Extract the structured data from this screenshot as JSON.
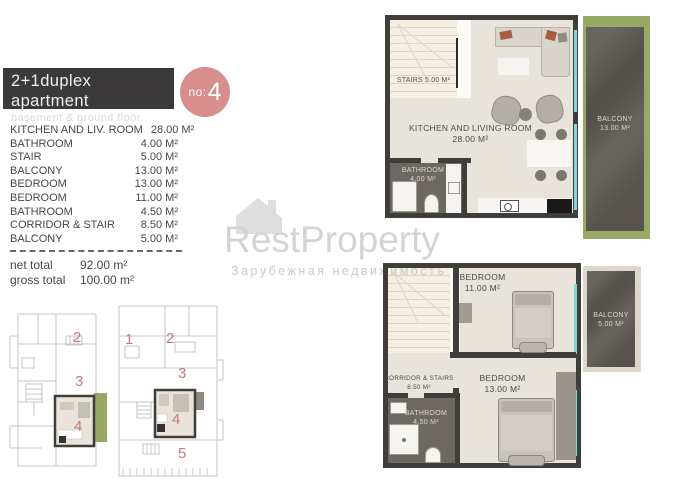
{
  "header": {
    "title": "2+1duplex apartment",
    "subtitle": "basement & ground floor",
    "unit_badge": {
      "prefix": "no:",
      "number": "4"
    }
  },
  "room_list": {
    "rows": [
      {
        "label": "KITCHEN AND LIV. ROOM",
        "value": "28.00 M²"
      },
      {
        "label": "BATHROOM",
        "value": "4.00 M²"
      },
      {
        "label": "STAIR",
        "value": "5.00 M²"
      },
      {
        "label": "BALCONY",
        "value": "13.00 M²"
      },
      {
        "label": "BEDROOM",
        "value": "13.00 M²"
      },
      {
        "label": "BEDROOM",
        "value": "11.00 M²"
      },
      {
        "label": "BATHROOM",
        "value": "4.50 M²"
      },
      {
        "label": "CORRIDOR & STAIR",
        "value": "8.50 M²"
      },
      {
        "label": "BALCONY",
        "value": "5.00 M²"
      }
    ],
    "totals": [
      {
        "label": "net total",
        "value": "92.00 m²"
      },
      {
        "label": "gross total",
        "value": "100.00 m²"
      }
    ]
  },
  "plans": {
    "upper": {
      "stairs_label": "STAIRS 5.00 M²",
      "kitchen_living": {
        "name": "KITCHEN AND LIVING ROOM",
        "area": "28.00 M²"
      },
      "bathroom": {
        "name": "BATHROOM",
        "area": "4.00 M²"
      },
      "balcony": {
        "name": "BALCONY",
        "area": "13.00 M²"
      }
    },
    "lower": {
      "bedroom_small": {
        "name": "BEDROOM",
        "area": "11.00 M²"
      },
      "bedroom_large": {
        "name": "BEDROOM",
        "area": "13.00 M²"
      },
      "balcony": {
        "name": "BALCONY",
        "area": "5.00 M²"
      },
      "corridor": {
        "name": "CORRIDOR & STAIRS",
        "area": "8.50 M²"
      },
      "bathroom": {
        "name": "BATHROOM",
        "area": "4.50 M²"
      }
    }
  },
  "site_plans": {
    "left_units": [
      "2",
      "3",
      "4"
    ],
    "right_units": [
      "1",
      "2",
      "3",
      "4",
      "5"
    ]
  },
  "watermark": {
    "brand": "RestProperty",
    "tagline": "Зарубежная недвижимость"
  },
  "colors": {
    "header_bg": "#3b393a",
    "badge": "#d88e8c",
    "wall": "#403e3d",
    "floor": "#e9e4db",
    "stairs_floor": "#f4efe1",
    "dark_floor": "#6e6862",
    "balcony_stone": "#5f5a54",
    "grass": "#97a964",
    "window": "#7fd8dc",
    "unit_number": "#bd7d78"
  }
}
